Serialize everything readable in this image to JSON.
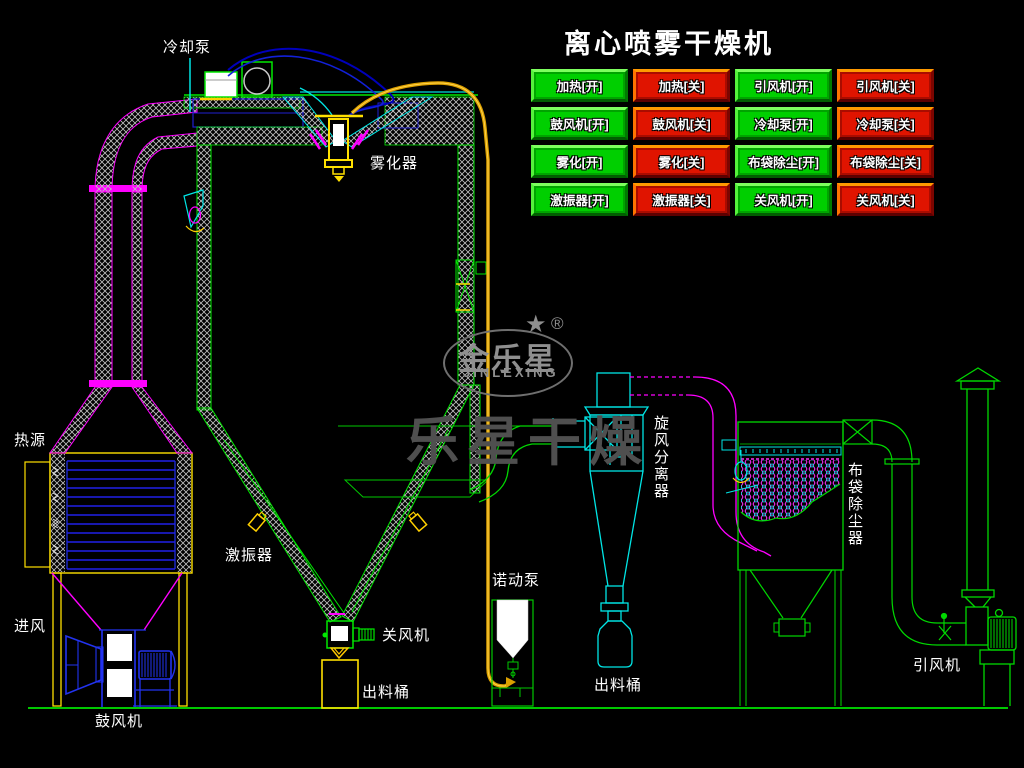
{
  "title": "离心喷雾干燥机",
  "panel": {
    "on_color": "#00CF00",
    "off_color": "#E01400",
    "buttons": [
      {
        "label": "加热[开]",
        "state": "on"
      },
      {
        "label": "加热[关]",
        "state": "off"
      },
      {
        "label": "引风机[开]",
        "state": "on"
      },
      {
        "label": "引风机[关]",
        "state": "off"
      },
      {
        "label": "鼓风机[开]",
        "state": "on"
      },
      {
        "label": "鼓风机[关]",
        "state": "off"
      },
      {
        "label": "冷却泵[开]",
        "state": "on"
      },
      {
        "label": "冷却泵[关]",
        "state": "off"
      },
      {
        "label": "雾化[开]",
        "state": "on"
      },
      {
        "label": "雾化[关]",
        "state": "off"
      },
      {
        "label": "布袋除尘[开]",
        "state": "on"
      },
      {
        "label": "布袋除尘[关]",
        "state": "off"
      },
      {
        "label": "激振器[开]",
        "state": "on"
      },
      {
        "label": "激振器[关]",
        "state": "off"
      },
      {
        "label": "关风机[开]",
        "state": "on"
      },
      {
        "label": "关风机[关]",
        "state": "off"
      }
    ]
  },
  "labels": {
    "cooling_pump": "冷却泵",
    "atomizer": "雾化器",
    "heat_source": "热源",
    "air_inlet": "进风",
    "blower": "鼓风机",
    "vibrator": "激振器",
    "rotary_valve": "关风机",
    "discharge_barrel_left": "出料桶",
    "feed_pump": "诺动泵",
    "discharge_barrel_right": "出料桶",
    "cyclone": "旋风分离器",
    "bag_filter": "布袋除尘器",
    "induced_draft_fan": "引风机"
  },
  "logo": {
    "brand": "金乐星",
    "star": "★",
    "registered": "®",
    "romanized": "JINLEXING",
    "watermark": "乐星干燥"
  },
  "colors": {
    "background": "#000000",
    "schematic_green": "#00E000",
    "schematic_cyan": "#00E5E5",
    "schematic_magenta": "#FF00FF",
    "schematic_blue": "#2233F0",
    "schematic_yellow": "#FFE000",
    "pipe_orange": "#DCA000",
    "hatch_gray": "#C0C0C0",
    "label_white": "#FFFFFF"
  }
}
